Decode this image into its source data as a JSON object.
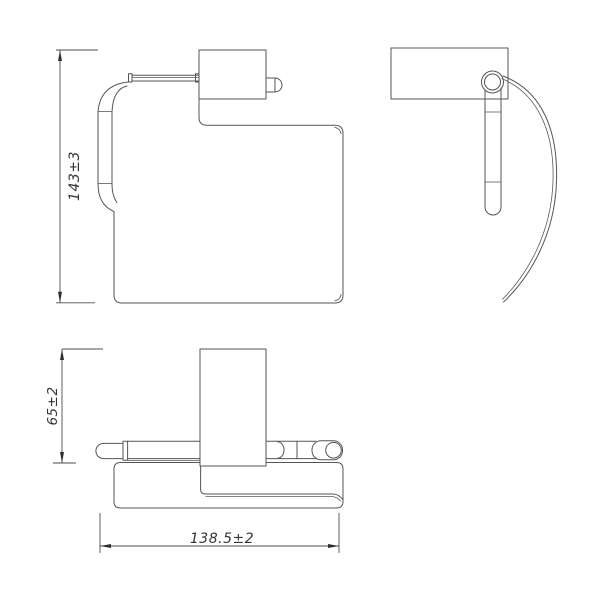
{
  "drawing": {
    "dimensions": {
      "height": {
        "label": "143±3"
      },
      "depth": {
        "label": "65±2"
      },
      "width": {
        "label": "138.5±2"
      }
    },
    "colors": {
      "background": "#ffffff",
      "line": "#555555",
      "dimension_line": "#4d4d4d",
      "text": "#333333"
    }
  }
}
